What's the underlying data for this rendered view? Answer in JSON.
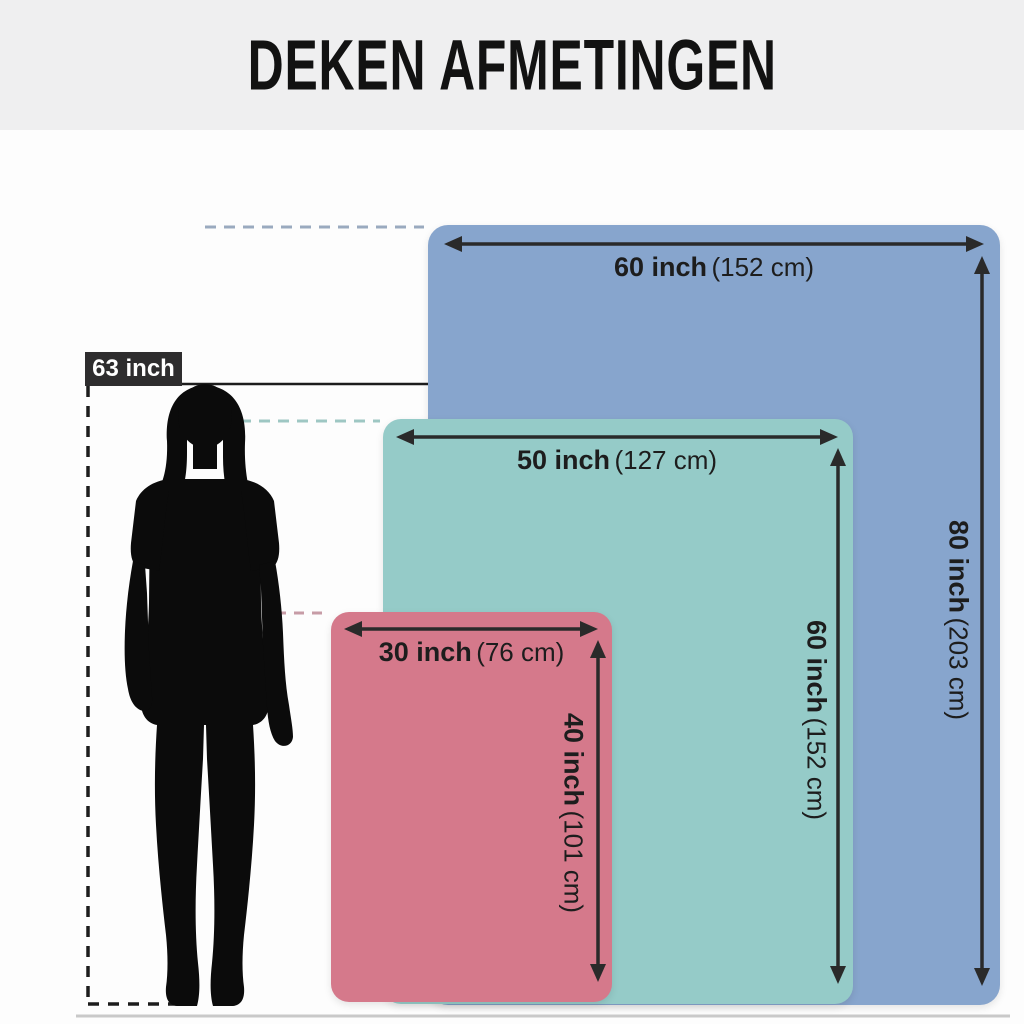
{
  "title": "DEKEN AFMETINGEN",
  "person": {
    "height_label": "63 inch"
  },
  "blankets": [
    {
      "id": "large",
      "fill": "#87a5cd",
      "width": {
        "label": "60 inch",
        "metric": "(152 cm)",
        "inch": 60,
        "cm": 152
      },
      "height": {
        "label": "80 inch",
        "metric": "(203 cm)",
        "inch": 80,
        "cm": 203
      }
    },
    {
      "id": "medium",
      "fill": "#95cbc8",
      "width": {
        "label": "50 inch",
        "metric": "(127 cm)",
        "inch": 50,
        "cm": 127
      },
      "height": {
        "label": "60 inch",
        "metric": "(152 cm)",
        "inch": 60,
        "cm": 152
      }
    },
    {
      "id": "small",
      "fill": "#d5798b",
      "width": {
        "label": "30 inch",
        "metric": "(76 cm)",
        "inch": 30,
        "cm": 76
      },
      "height": {
        "label": "40 inch",
        "metric": "(101 cm)",
        "inch": 40,
        "cm": 101
      }
    }
  ],
  "colors": {
    "header_bg": "#efeff0",
    "badge_bg": "#2e2d2e",
    "arrow": "#2a2a2a",
    "silhouette": "#0b0b0b",
    "dash_black": "#1c1c1c",
    "dash_blue": "#9aaabf",
    "dash_teal": "#9ec7c3",
    "dash_pink": "#c79ca6",
    "floor_line": "#c9c9c9"
  }
}
